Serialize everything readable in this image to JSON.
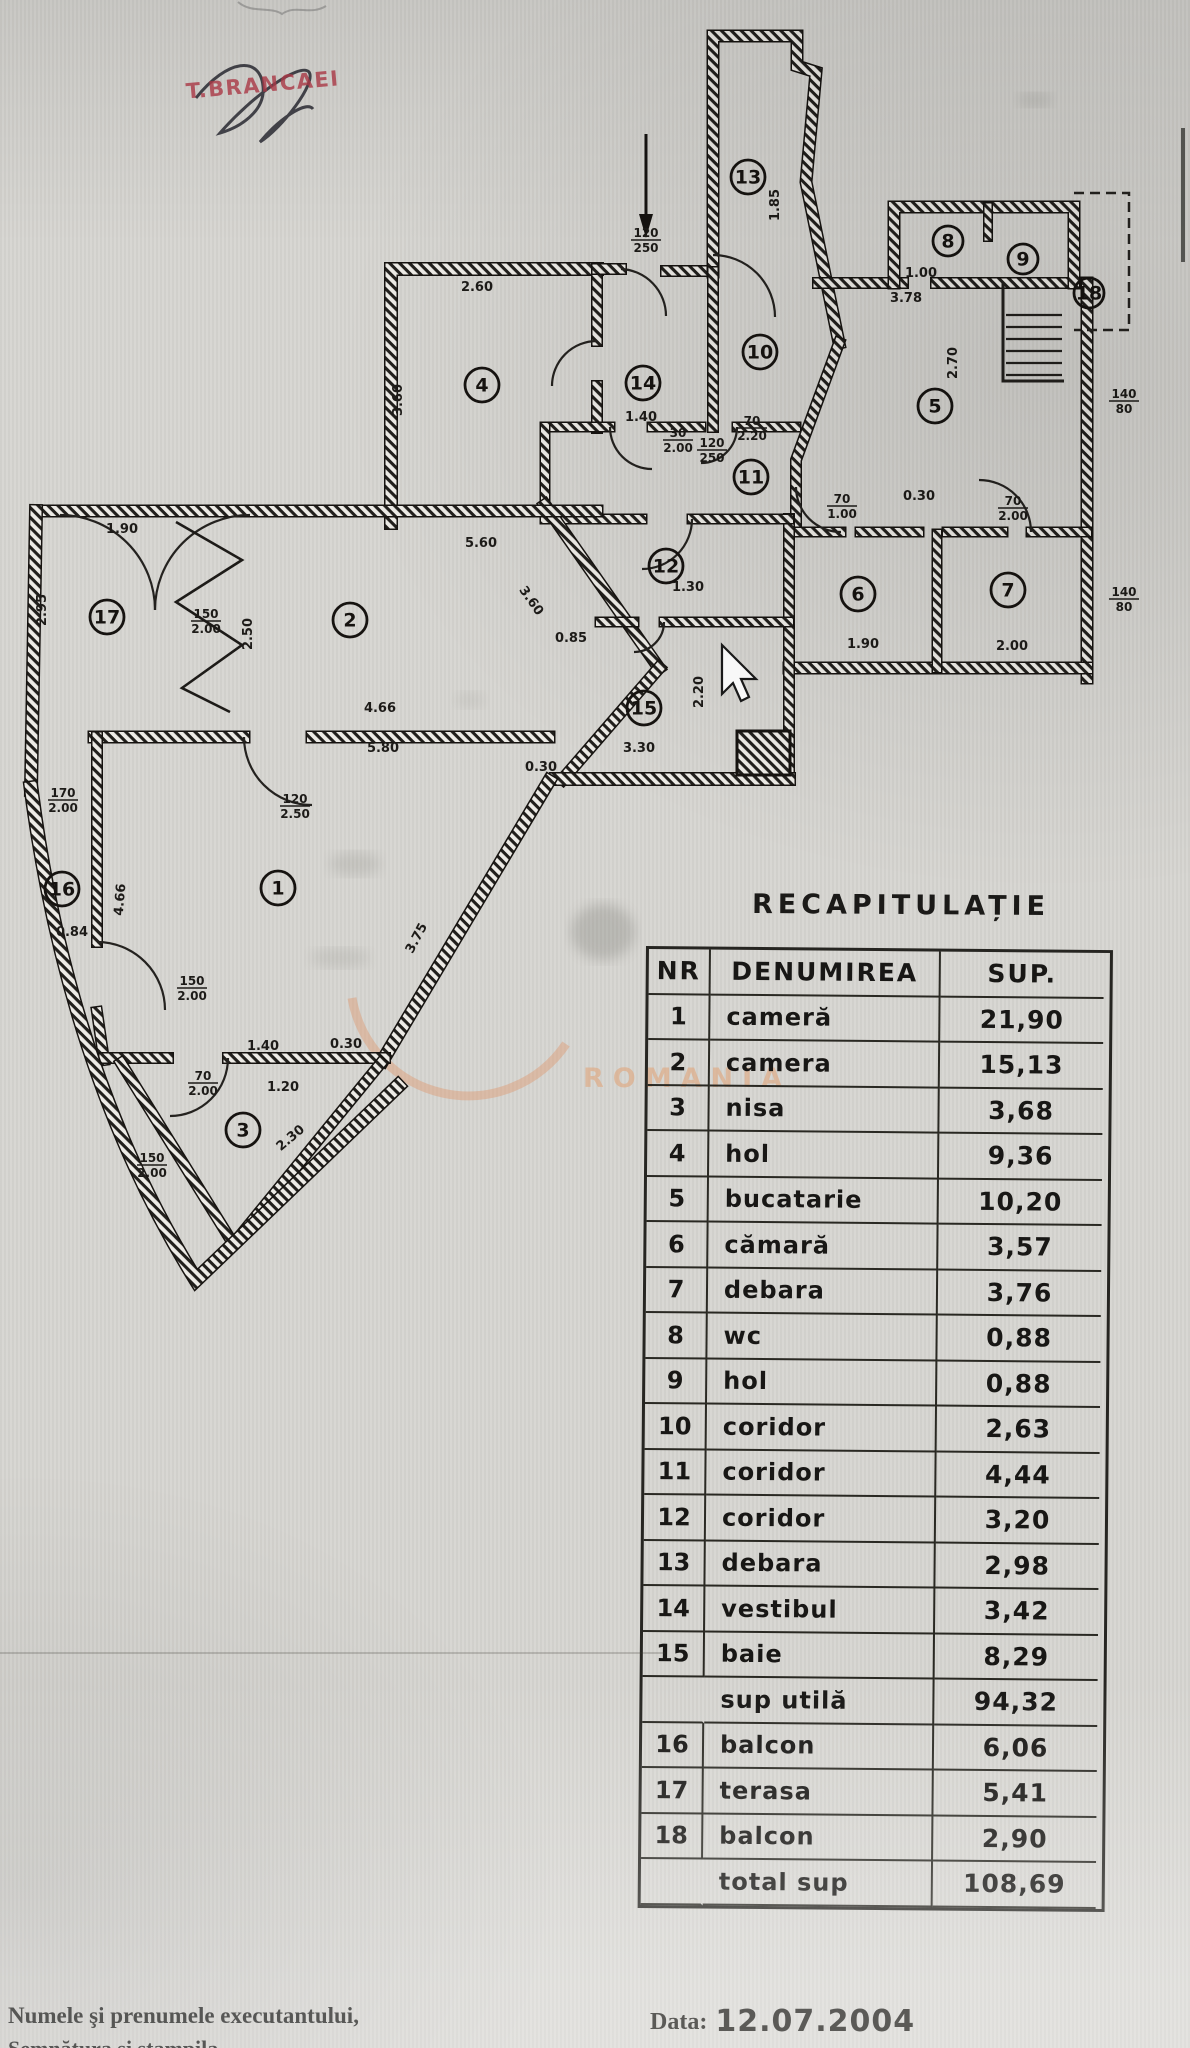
{
  "stamp": {
    "text": "T.BRANCAEI"
  },
  "watermark": {
    "text": "ROMANIA"
  },
  "plan": {
    "rooms": [
      {
        "nr": "1",
        "x": 278,
        "y": 888
      },
      {
        "nr": "2",
        "x": 350,
        "y": 620
      },
      {
        "nr": "3",
        "x": 243,
        "y": 1130
      },
      {
        "nr": "4",
        "x": 482,
        "y": 385
      },
      {
        "nr": "5",
        "x": 935,
        "y": 406
      },
      {
        "nr": "6",
        "x": 858,
        "y": 594
      },
      {
        "nr": "7",
        "x": 1008,
        "y": 590
      },
      {
        "nr": "8",
        "x": 948,
        "y": 241,
        "s": 1
      },
      {
        "nr": "9",
        "x": 1023,
        "y": 259,
        "s": 1
      },
      {
        "nr": "10",
        "x": 760,
        "y": 352
      },
      {
        "nr": "11",
        "x": 751,
        "y": 477
      },
      {
        "nr": "12",
        "x": 666,
        "y": 566
      },
      {
        "nr": "13",
        "x": 748,
        "y": 177
      },
      {
        "nr": "14",
        "x": 643,
        "y": 383
      },
      {
        "nr": "15",
        "x": 644,
        "y": 708
      },
      {
        "nr": "16",
        "x": 62,
        "y": 889
      },
      {
        "nr": "17",
        "x": 107,
        "y": 617
      },
      {
        "nr": "18",
        "x": 1089,
        "y": 293,
        "s": 1
      }
    ],
    "dims": [
      {
        "t": "2.60",
        "x": 477,
        "y": 291
      },
      {
        "t": "3.60",
        "x": 402,
        "y": 400,
        "r": -90
      },
      {
        "t": "120",
        "b": "250",
        "x": 646,
        "y": 237,
        "f": 1
      },
      {
        "t": "1.40",
        "x": 641,
        "y": 421
      },
      {
        "t": "30",
        "b": "2.00",
        "x": 678,
        "y": 437,
        "f": 1
      },
      {
        "t": "120",
        "b": "250",
        "x": 712,
        "y": 447,
        "f": 1
      },
      {
        "t": "70",
        "b": "2.20",
        "x": 752,
        "y": 425,
        "f": 1
      },
      {
        "t": "1.85",
        "x": 779,
        "y": 205,
        "r": -90
      },
      {
        "t": "3.78",
        "x": 906,
        "y": 302
      },
      {
        "t": "2.70",
        "x": 957,
        "y": 363,
        "r": -90
      },
      {
        "t": "1.00",
        "x": 921,
        "y": 277
      },
      {
        "t": "140",
        "b": "80",
        "x": 1124,
        "y": 398,
        "f": 1
      },
      {
        "t": "140",
        "b": "80",
        "x": 1124,
        "y": 596,
        "f": 1
      },
      {
        "t": "0.30",
        "x": 919,
        "y": 500
      },
      {
        "t": "70",
        "b": "2.00",
        "x": 1013,
        "y": 505,
        "f": 1
      },
      {
        "t": "70",
        "b": "1.00",
        "x": 842,
        "y": 503,
        "f": 1
      },
      {
        "t": "1.90",
        "x": 863,
        "y": 648
      },
      {
        "t": "2.00",
        "x": 1012,
        "y": 650
      },
      {
        "t": "1.90",
        "x": 122,
        "y": 533
      },
      {
        "t": "2.95",
        "x": 46,
        "y": 610,
        "r": -90
      },
      {
        "t": "150",
        "b": "2.00",
        "x": 206,
        "y": 618,
        "f": 1
      },
      {
        "t": "2.50",
        "x": 252,
        "y": 634,
        "r": -90
      },
      {
        "t": "4.66",
        "x": 380,
        "y": 712
      },
      {
        "t": "5.80",
        "x": 383,
        "y": 752
      },
      {
        "t": "0.30",
        "x": 541,
        "y": 771
      },
      {
        "t": "3.30",
        "x": 639,
        "y": 752
      },
      {
        "t": "2.20",
        "x": 703,
        "y": 692,
        "r": -90
      },
      {
        "t": "5.60",
        "x": 481,
        "y": 547
      },
      {
        "t": "3.60",
        "x": 528,
        "y": 603,
        "r": 55
      },
      {
        "t": "170",
        "b": "2.00",
        "x": 63,
        "y": 797,
        "f": 1
      },
      {
        "t": "0.84",
        "x": 72,
        "y": 936
      },
      {
        "t": "4.66",
        "x": 124,
        "y": 900,
        "r": -85
      },
      {
        "t": "150",
        "b": "2.00",
        "x": 192,
        "y": 985,
        "f": 1
      },
      {
        "t": "120",
        "b": "2.50",
        "x": 295,
        "y": 803,
        "f": 1
      },
      {
        "t": "1.40",
        "x": 263,
        "y": 1050
      },
      {
        "t": "0.30",
        "x": 346,
        "y": 1048
      },
      {
        "t": "70",
        "b": "2.00",
        "x": 203,
        "y": 1080,
        "f": 1
      },
      {
        "t": "1.20",
        "x": 283,
        "y": 1091
      },
      {
        "t": "150",
        "b": "2.00",
        "x": 152,
        "y": 1162,
        "f": 1
      },
      {
        "t": "2.30",
        "x": 293,
        "y": 1141,
        "r": -40
      },
      {
        "t": "3.75",
        "x": 420,
        "y": 940,
        "r": -62
      },
      {
        "t": "1.30",
        "x": 688,
        "y": 591
      },
      {
        "t": "0.85",
        "x": 571,
        "y": 642
      }
    ]
  },
  "table": {
    "title": "RECAPITULAȚIE",
    "headers": {
      "nr": "NR",
      "name": "DENUMIREA",
      "sup": "SUP."
    },
    "rows": [
      {
        "nr": "1",
        "name": "cameră",
        "sup": "21,90"
      },
      {
        "nr": "2",
        "name": "camera",
        "sup": "15,13"
      },
      {
        "nr": "3",
        "name": "nisa",
        "sup": "3,68"
      },
      {
        "nr": "4",
        "name": "hol",
        "sup": "9,36"
      },
      {
        "nr": "5",
        "name": "bucatarie",
        "sup": "10,20"
      },
      {
        "nr": "6",
        "name": "cămară",
        "sup": "3,57"
      },
      {
        "nr": "7",
        "name": "debara",
        "sup": "3,76"
      },
      {
        "nr": "8",
        "name": "wc",
        "sup": "0,88"
      },
      {
        "nr": "9",
        "name": "hol",
        "sup": "0,88"
      },
      {
        "nr": "10",
        "name": "coridor",
        "sup": "2,63"
      },
      {
        "nr": "11",
        "name": "coridor",
        "sup": "4,44"
      },
      {
        "nr": "12",
        "name": "coridor",
        "sup": "3,20"
      },
      {
        "nr": "13",
        "name": "debara",
        "sup": "2,98"
      },
      {
        "nr": "14",
        "name": "vestibul",
        "sup": "3,42"
      },
      {
        "nr": "15",
        "name": "baie",
        "sup": "8,29"
      },
      {
        "nr": "",
        "name": "sup utilă",
        "sup": "94,32",
        "summary": true
      },
      {
        "nr": "16",
        "name": "balcon",
        "sup": "6,06"
      },
      {
        "nr": "17",
        "name": "terasa",
        "sup": "5,41"
      },
      {
        "nr": "18",
        "name": "balcon",
        "sup": "2,90"
      },
      {
        "nr": "",
        "name": "total sup",
        "sup": "108,69",
        "summary": true
      }
    ]
  },
  "footer": {
    "left_line1": "Numele şi prenumele executantului,",
    "left_line2": "Semnătura şi ştampila",
    "date_label": "Data:",
    "date_value": "12.07.2004"
  }
}
